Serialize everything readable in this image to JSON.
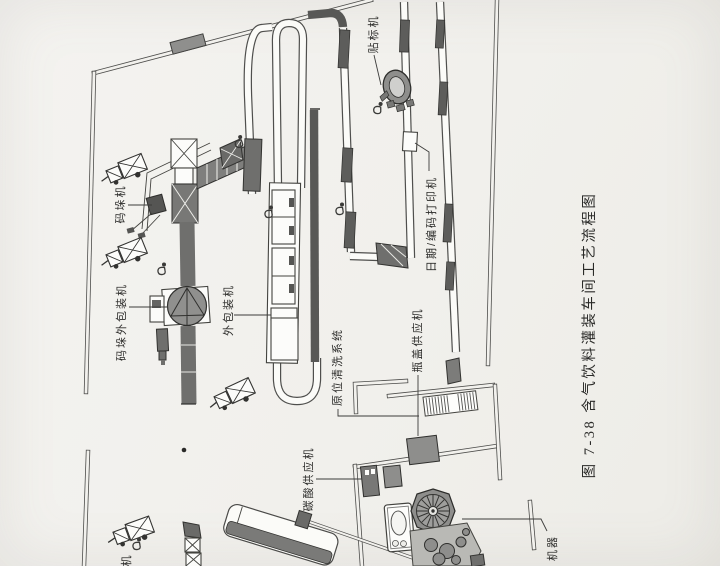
{
  "figure": {
    "caption": "图 7-38  含气饮料灌装车间工艺流程图",
    "labels": {
      "palletizer": "码垛机",
      "pallet_outer_packer": "码垛外包装机",
      "outer_packer": "外包装机",
      "cip_system": "原位清洗系统",
      "carbonation_supply": "碳酸供应机",
      "cap_supply": "瓶盖供应机",
      "labeler": "贴标机",
      "date_code_printer": "日期/编码打印机",
      "machine_partial_right": "机器",
      "machine_partial_left": "机"
    },
    "colors": {
      "paper": "#f2f1ee",
      "ink": "#3a3a38",
      "machine_dark": "#6f6f6d",
      "machine_mid": "#8e8e8c",
      "machine_light": "#fbfbf9"
    }
  }
}
